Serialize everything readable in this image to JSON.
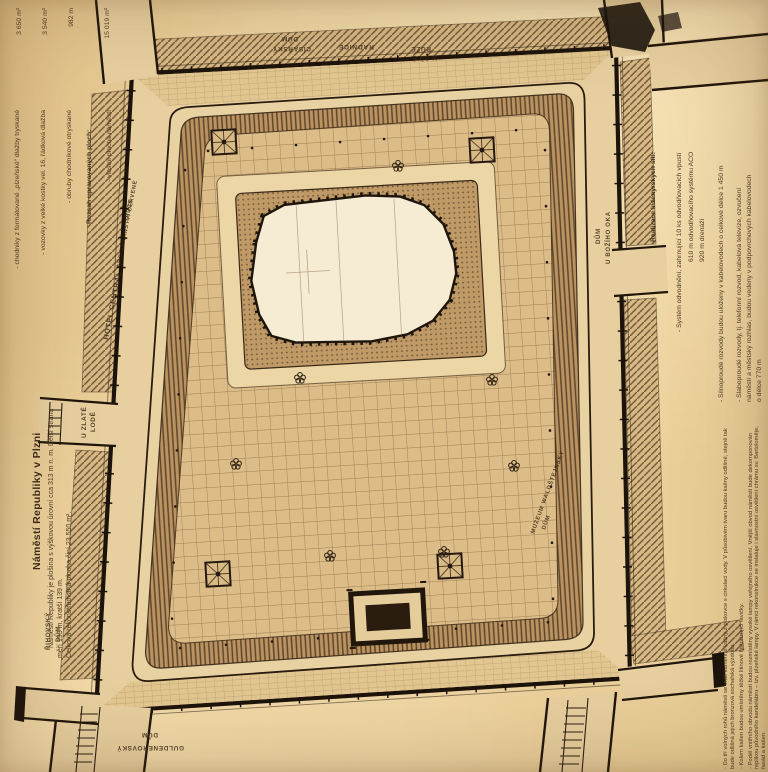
{
  "page_title": "Náměstí Republiky v Plzni",
  "colors": {
    "paper": "#ecd19b",
    "ink": "#241b10",
    "street_fill": "#e7cf9f",
    "plaza_band": "#bb9462",
    "cathedral_fill": "#f6ecd4",
    "text_brown": "#4e3a22"
  },
  "left_column": {
    "title": "Náměstí Republiky v Plzni",
    "intro_lines": [
      "Náměstí Republiky je plošina s výškovou úrovní cca 313 m n. m. Delší strana",
      "měří 193 m, kratší 139 m.",
      "Celková rekonstruovaná plocha činí 23 550 m²."
    ]
  },
  "areas_block": {
    "header": "Rozsah upravovaných ploch:",
    "items": [
      {
        "label": "- chodníky z formátované „plzeňské“ dlažby tryskané",
        "value": "3 650 m²"
      },
      {
        "label": "- vozovky z velké kostky vel. 16, řádková dlažba",
        "value": "3 540 m²"
      },
      {
        "label": "- obruby chodníkové otryskané",
        "value": "982 m"
      },
      {
        "label": "- vlastní plocha náměstí",
        "value": "15 019 m²"
      }
    ]
  },
  "networks_block": {
    "header": "Realizace inženýrských sítí:",
    "item1_line1": "- Systém odvodnění, zahrnující 10 ks odvodňovacích vpustí",
    "item1_line2": "610 m odvodňovacího systému ACO",
    "item1_line3": "920 m drenáží",
    "item2_line1": "- Silnoproudé rozvody budou uloženy v kabelovodech o celkové délce 1 450 m",
    "item3_line1": "- Slaboproudé rozvody, tj. telefonní rozvod, kabelová televize, ozvučení",
    "item3_line2": "náměstí a městský rozhlas, budou vedeny v podpovrchových kabelovodech",
    "item3_line3": "o délce 770 m"
  },
  "notes_block": {
    "p1": "- Do tří volných rohů náměstí se vrátí kamenné kašny z pískovce s cirkulací vody. V působivém tvaru budou kašny odlišné, stejně tak bude odlišná jejich bronzová sochařská výzdoba.",
    "p2": "- Kolem kašen budou umístěny těžké litinové historizující lavičky.",
    "p3": "- Podél vnitřního obvodu náměstí budou rozmístěny vysoké lampy veřejného osvětlení. Vnější obvod náměstí bude dekomponován replikou původního kandelábru – tzv. plzeňské lampy. V rámci rekonstrukce se instaluje i slavnostní osvětlení chrámu sv. Bartoloměje, fasád a kašen.",
    "p4": "- K doplňujícím prvkům plochy náměstí budou patřit litinové patníky, které budou mít i další technické funkce."
  },
  "map": {
    "labels": {
      "radnice": "RADNICE",
      "cisarsky_line1": "CÍSAŘSKÝ",
      "cisarsky_line2": "DŮM",
      "ubile_line1": "U BÍLÉ",
      "ubile_line2": "RŮŽE",
      "hotel_central": "HOTEL CENTRAL",
      "arcidekanstvi": "ARCIDĚKANSTVÍ ČERVENÉ",
      "srdce": "SRDCE",
      "uzlate_line1": "U ZLATÉ",
      "uzlate_line2": "LODĚ",
      "rihovsky_line1": "ŘIHOVSKÝ",
      "rihovsky_line2": "DŮM",
      "boziho_line1": "DŮM",
      "boziho_line2": "U BOŽÍHO OKA",
      "muzeum_line1": "MUZEUM WALDŠTEJNSKÝ",
      "muzeum_line2": "DŮM",
      "guldenerovsky_line1": "GULDENEROVSKÝ",
      "guldenerovsky_line2": "DŮM"
    }
  }
}
